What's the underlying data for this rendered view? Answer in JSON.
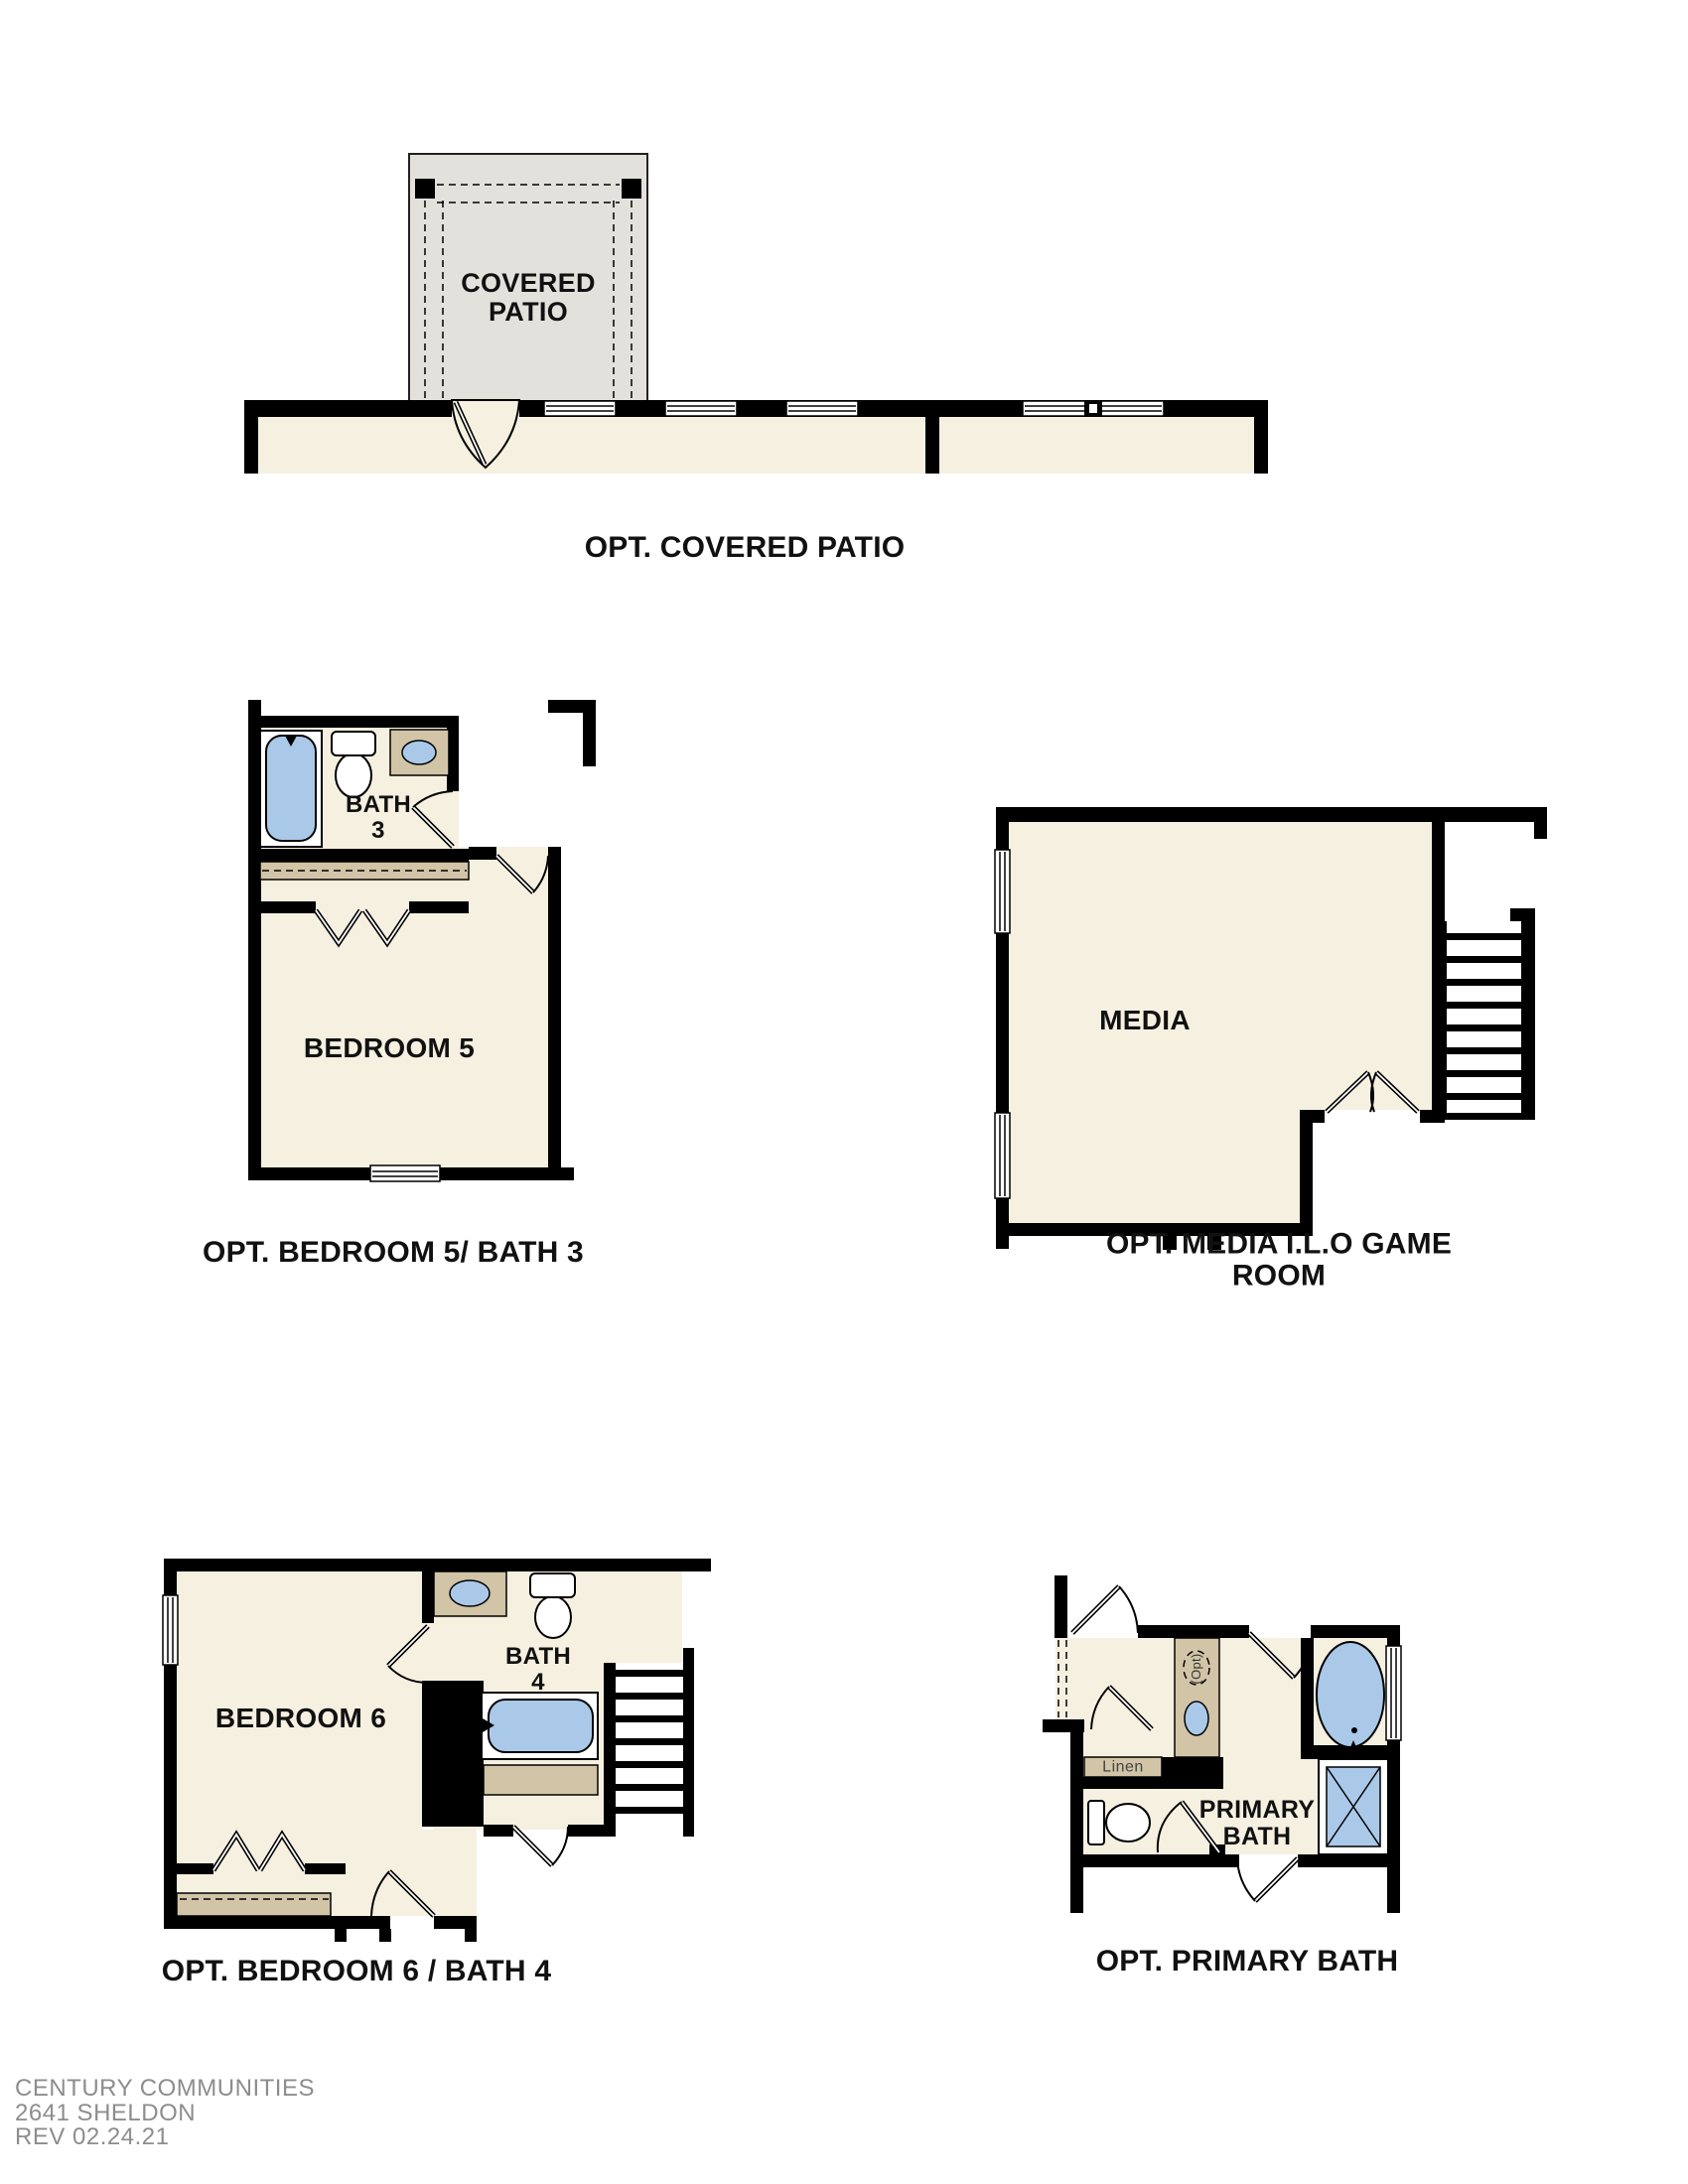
{
  "colors": {
    "floor_beige": "#f6f0e1",
    "patio_gray": "#e3e1dc",
    "cabinet_tan": "#d2c4a6",
    "fixture_blue": "#aac9e8",
    "wall_black": "#000000",
    "footer_gray": "#8d8d8d"
  },
  "plans": {
    "covered_patio": {
      "caption": "OPT. COVERED PATIO",
      "room_label": "COVERED\nPATIO"
    },
    "bedroom5_bath3": {
      "caption": "OPT. BEDROOM 5/ BATH 3",
      "bedroom_label": "BEDROOM 5",
      "bath_label": "BATH\n3"
    },
    "media": {
      "caption": "OPT. MEDIA I.L.O GAME ROOM",
      "room_label": "MEDIA"
    },
    "bedroom6_bath4": {
      "caption": "OPT. BEDROOM 6 / BATH 4",
      "bedroom_label": "BEDROOM 6",
      "bath_label": "BATH\n4"
    },
    "primary_bath": {
      "caption": "OPT. PRIMARY BATH",
      "room_label": "PRIMARY\nBATH",
      "linen_label": "Linen",
      "opt_sink_label": "(Opt)"
    }
  },
  "footer": {
    "company": "CENTURY COMMUNITIES",
    "plan_name": "2641 SHELDON",
    "revision": "REV 02.24.21"
  }
}
